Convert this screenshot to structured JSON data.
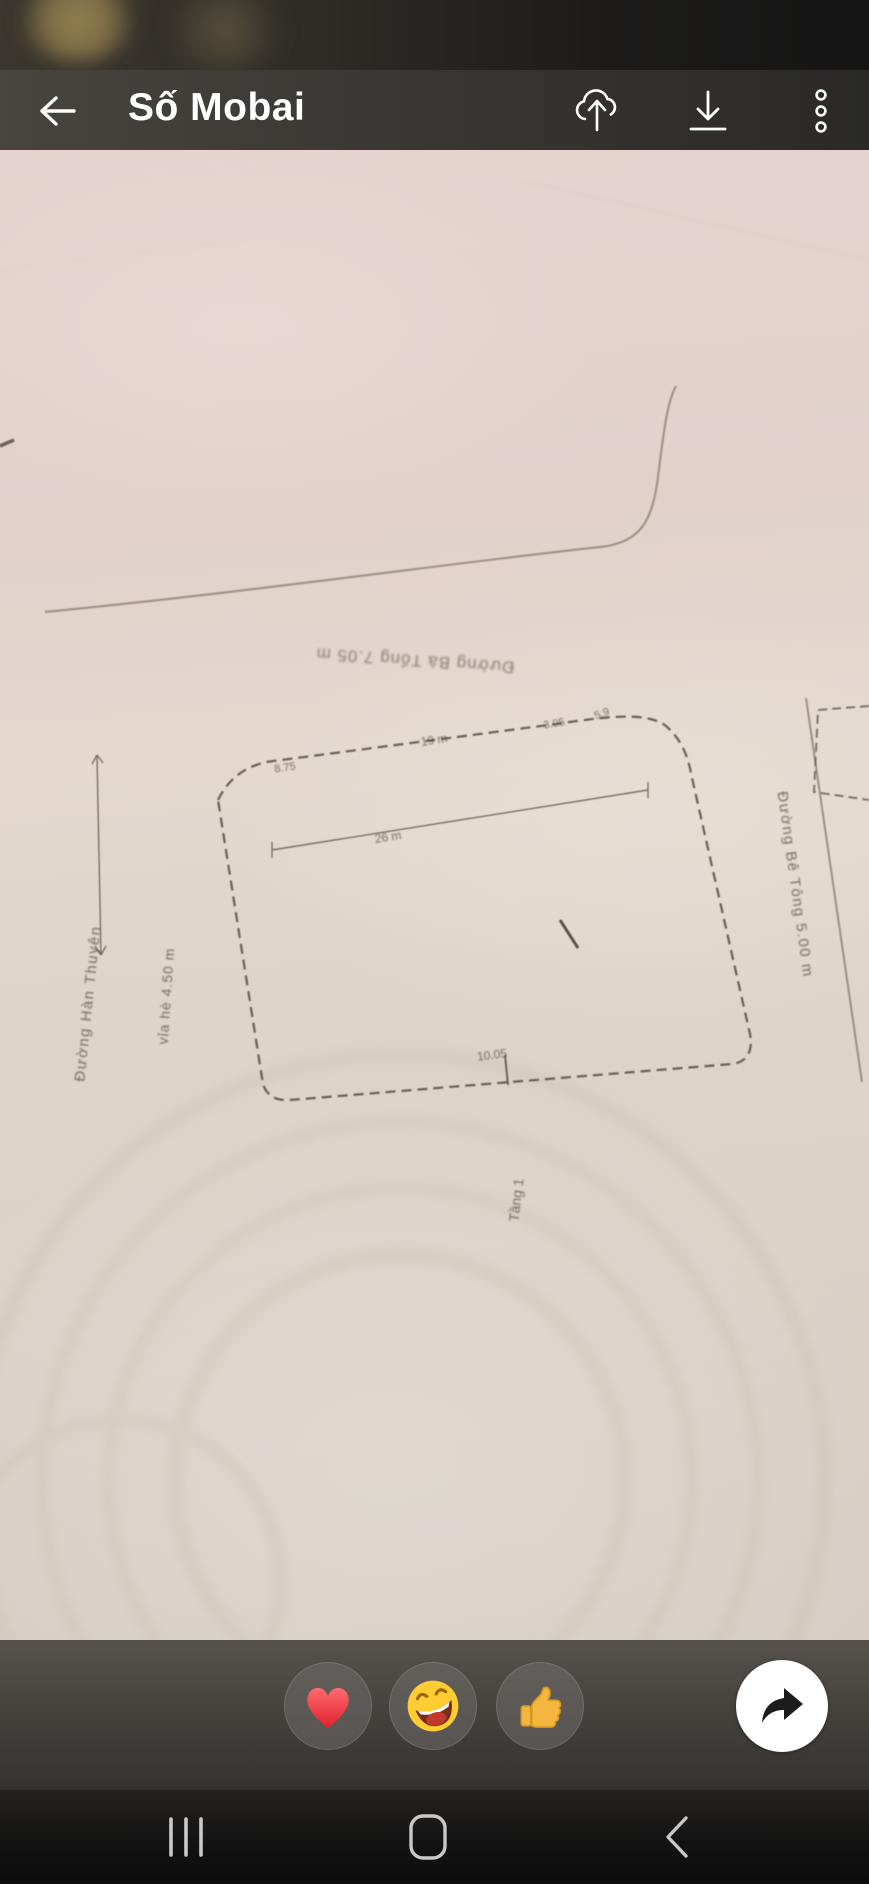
{
  "header": {
    "title": "Số Mobai"
  },
  "drawing": {
    "street_top": "Đường Bà Tổng 7.05 m",
    "street_left": "Đường Hàn Thuyên",
    "sidewalk_left": "vỉa hè 4.50 m",
    "street_right": "Đường Bê Tông 5.00 m",
    "floor_label": "Tầng 1",
    "dims": {
      "top_left": "8.75",
      "top": "19 m",
      "corner_a": "3.05",
      "corner_b": "5.9",
      "inner": "26 m",
      "bottom": "10.05"
    }
  },
  "colors": {
    "paper": "#e0d2cb",
    "header_bg": "#454340",
    "heart_red": "#ee2b3e",
    "emoji_yellow": "#ffcc33",
    "thumb_orange": "#f5b63f"
  }
}
